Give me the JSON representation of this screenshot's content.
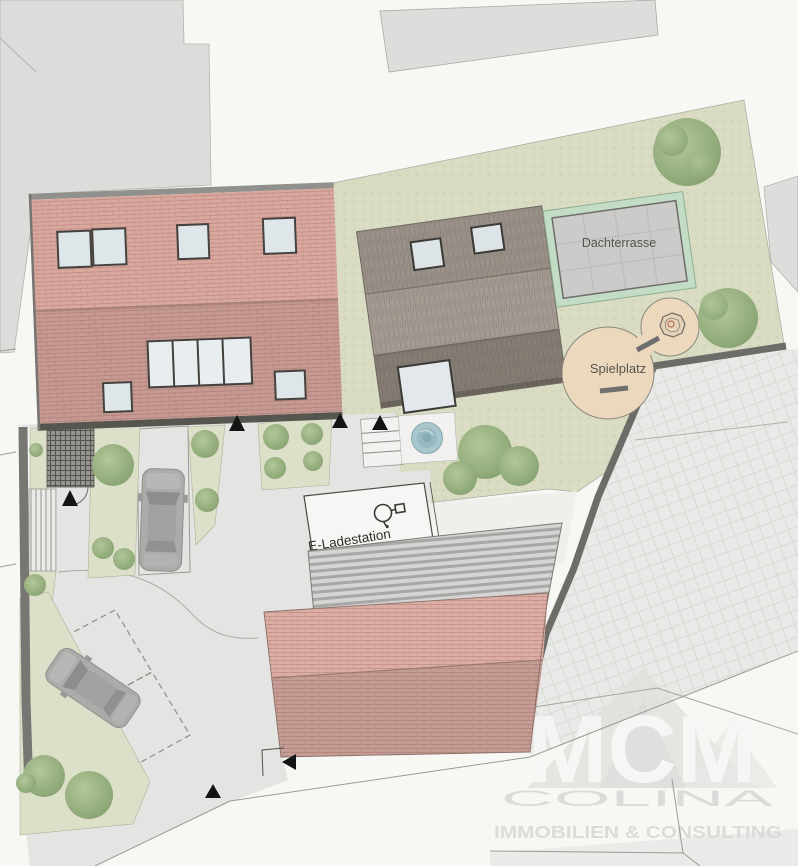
{
  "plan": {
    "labels": {
      "roof_terrace": "Dachterrasse",
      "playground": "Spielplatz",
      "ev_charging_station": "E-Ladestation"
    },
    "watermark": {
      "brand": "MCM",
      "name": "COLINA",
      "tagline": "IMMOBILIEN & CONSULTING"
    },
    "colors": {
      "brick_roof_light": "#d9a89f",
      "brick_roof_dark": "#c69a92",
      "gray_roof_light": "#a49c93",
      "gray_roof_dark": "#867e75",
      "corrugated_roof": "#d4d4d2",
      "lawn": "#d9dcc2",
      "playground_sand": "#ecd9bd",
      "water_feature": "#a9c6cd",
      "paving": "#e4e4e2",
      "neighbor_parcel": "#dcdcda",
      "retaining_wall": "#6e6c68",
      "tree_green": "#97b07f"
    },
    "features": {
      "cars_visible": 2,
      "benches": 2,
      "entrance_markers": 6,
      "skylights_front_building": 8,
      "skylights_rear_building": 3
    }
  }
}
